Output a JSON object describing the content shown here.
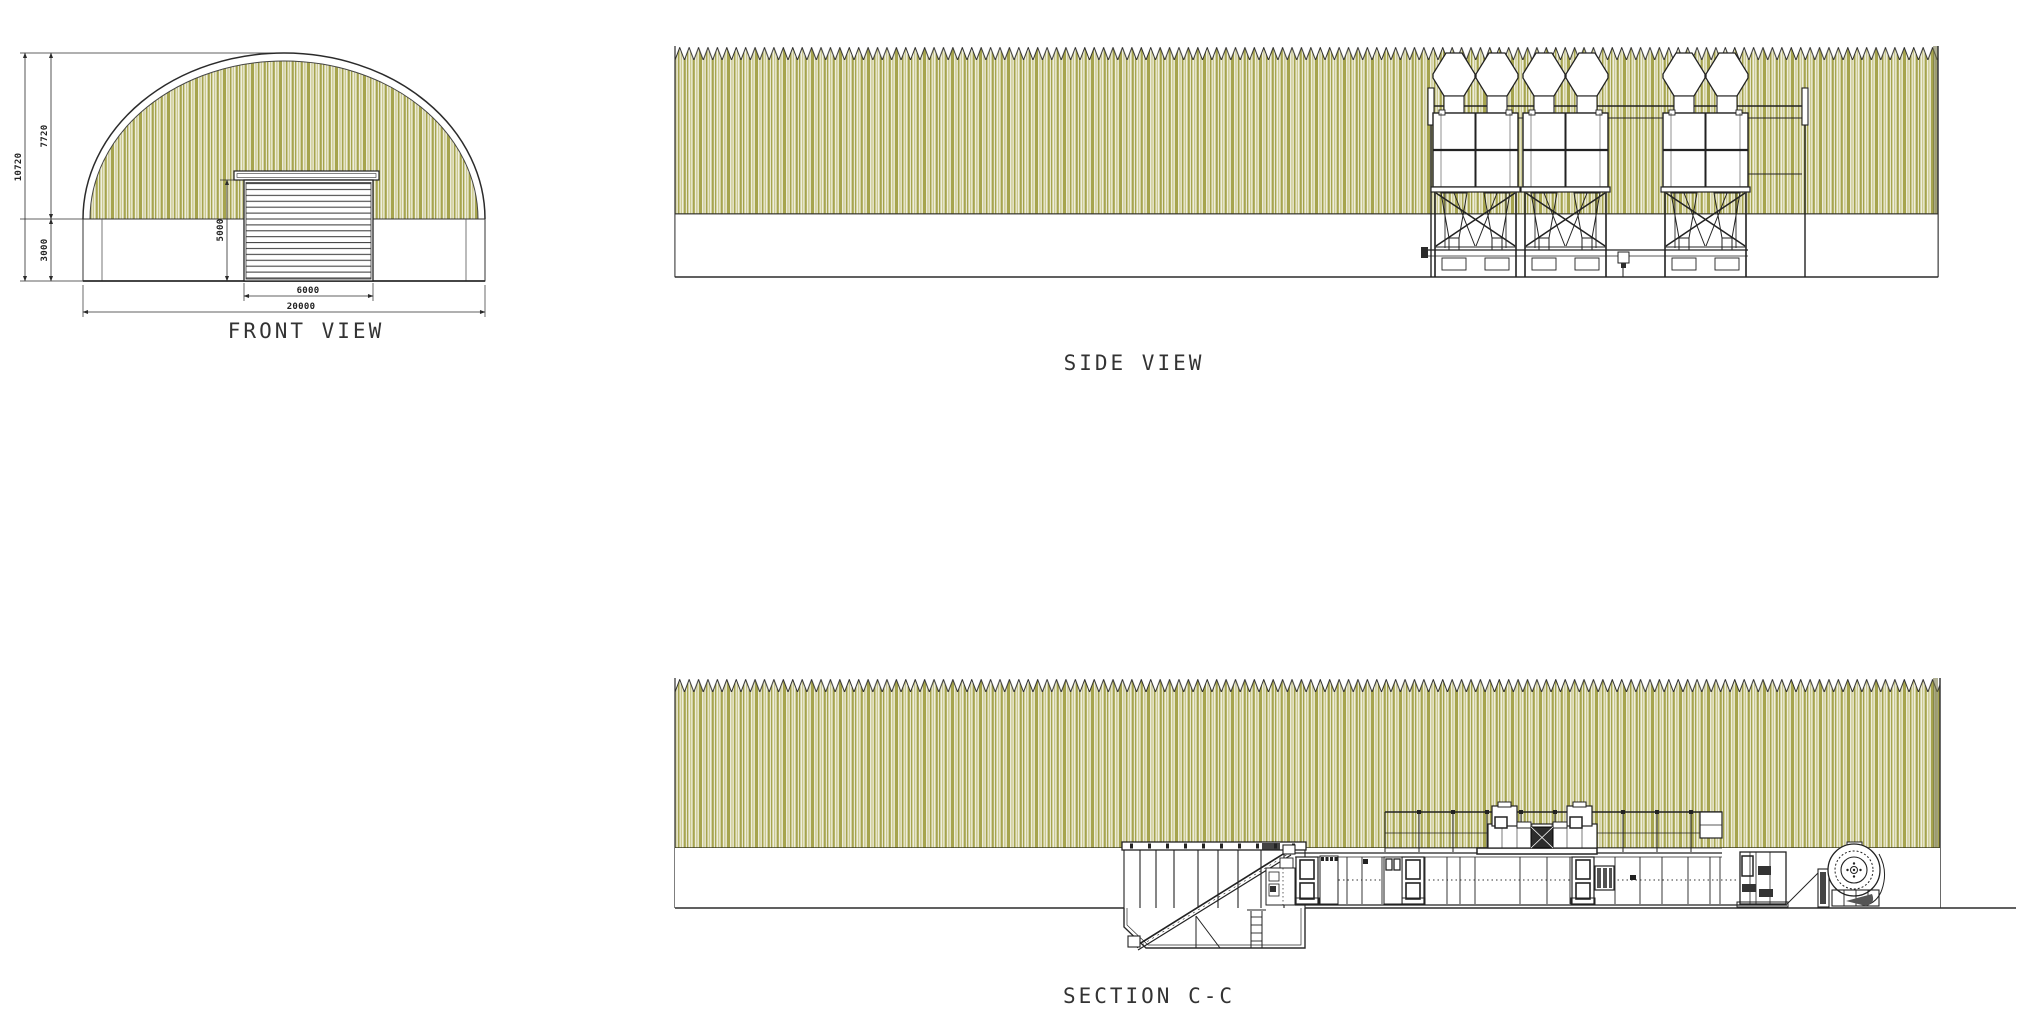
{
  "views": {
    "front": {
      "label": "FRONT VIEW",
      "dims": {
        "total_height": "10720",
        "arch_rise": "7720",
        "wall_height": "3000",
        "door_height": "5000",
        "door_width": "6000",
        "overall_width": "20000"
      }
    },
    "side": {
      "label": "SIDE VIEW"
    },
    "section": {
      "label": "SECTION C-C"
    }
  },
  "colors": {
    "olive": "#a6a44e",
    "olive_light": "#cbc98f",
    "cream": "#efeedc",
    "edge_shadow": "#6f6f3f",
    "line": "#2b2b2b"
  }
}
